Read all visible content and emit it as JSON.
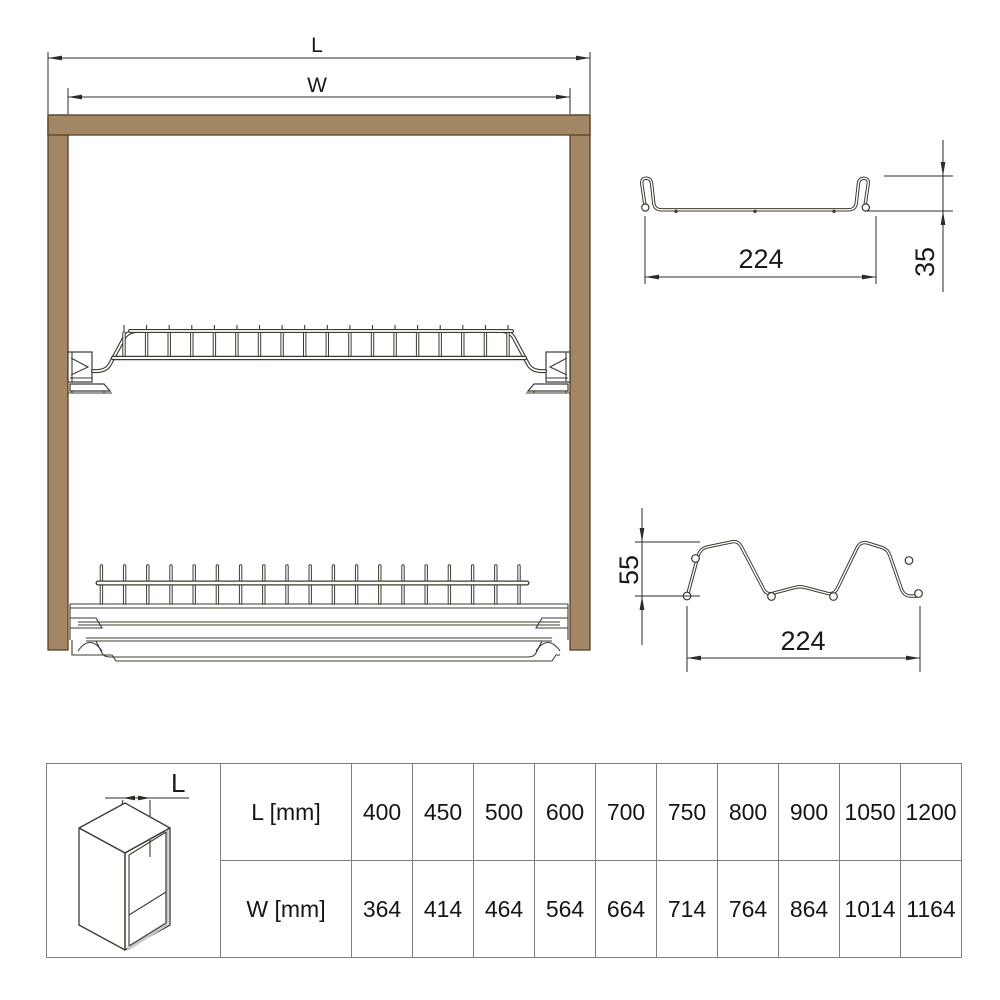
{
  "front_view": {
    "length_label": "L",
    "width_label": "W"
  },
  "profile_top": {
    "width_value": "224",
    "height_value": "35"
  },
  "profile_bottom": {
    "width_value": "224",
    "height_value": "55"
  },
  "size_table": {
    "icon_dim_label": "L",
    "rows": [
      {
        "header": "L [mm]",
        "values": [
          "400",
          "450",
          "500",
          "600",
          "700",
          "750",
          "800",
          "900",
          "1050",
          "1200"
        ]
      },
      {
        "header": "W [mm]",
        "values": [
          "364",
          "414",
          "464",
          "564",
          "664",
          "714",
          "764",
          "864",
          "1014",
          "1164"
        ]
      }
    ]
  },
  "colors": {
    "cabinet_panel": "#a38663",
    "cabinet_panel_stroke": "#54422b",
    "drawing_line": "#2e2b26",
    "wire_line": "#3f3a30",
    "table_border": "#7d7d7d",
    "background": "#ffffff"
  }
}
